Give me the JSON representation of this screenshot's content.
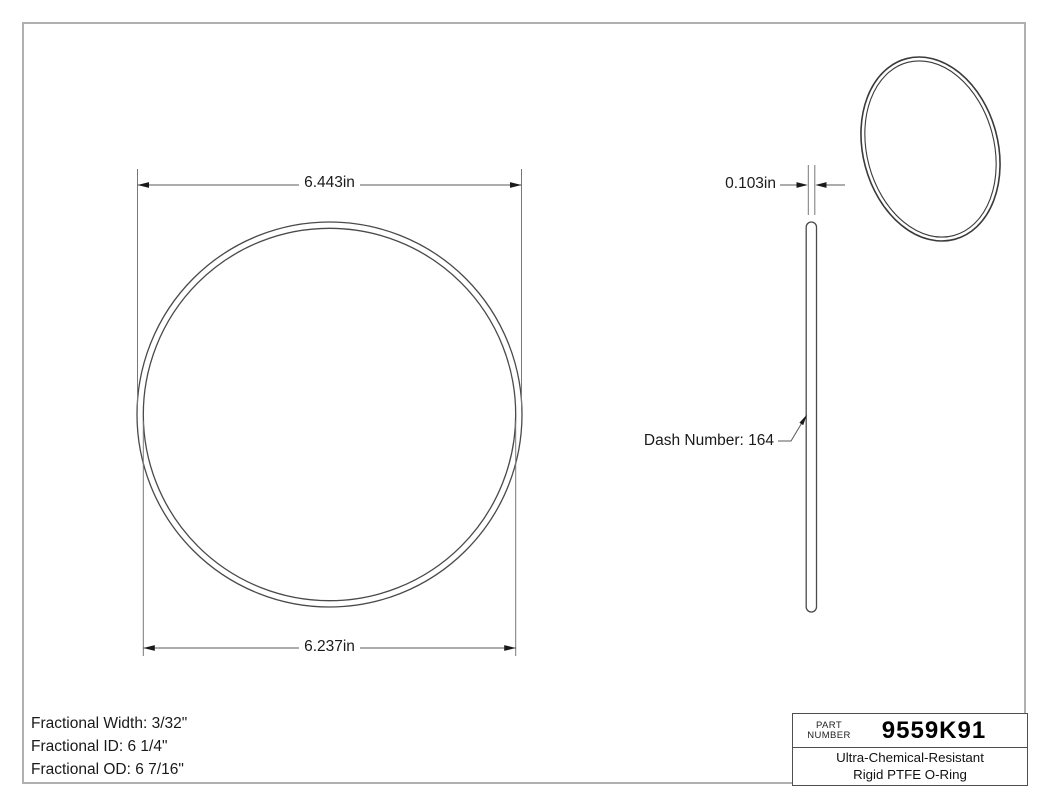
{
  "colors": {
    "page_border": "#b0b0b0",
    "line": "#4a4a4a",
    "dim_line": "#787878",
    "text": "#1a1a1a"
  },
  "front_view": {
    "od_label": "6.443in",
    "id_label": "6.237in"
  },
  "side_view": {
    "width_label": "0.103in",
    "dash_label": "Dash Number: 164"
  },
  "specs": {
    "width": "Fractional Width: 3/32\"",
    "id": "Fractional ID: 6 1/4\"",
    "od": "Fractional OD: 6 7/16\""
  },
  "title_block": {
    "label_line1": "PART",
    "label_line2": "NUMBER",
    "part_number": "9559K91",
    "description_line1": "Ultra-Chemical-Resistant",
    "description_line2": "Rigid PTFE O-Ring"
  }
}
